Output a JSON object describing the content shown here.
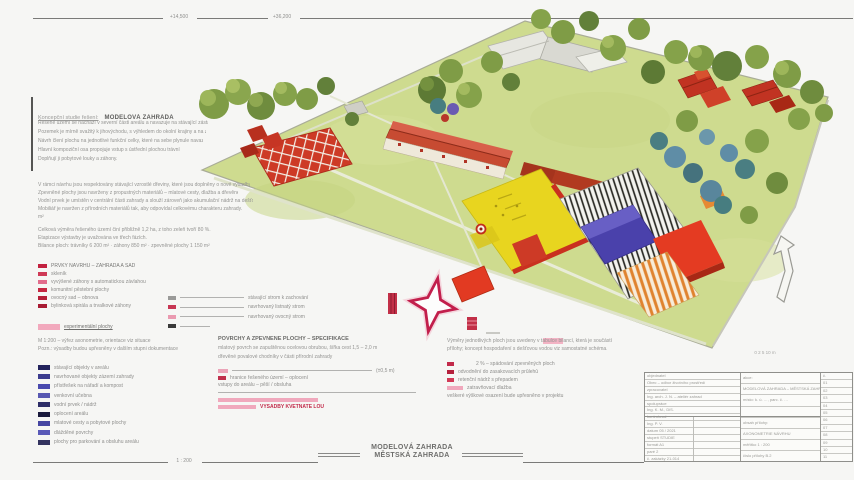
{
  "frame": {
    "top_label_1": "+14,500",
    "top_label_2": "+36,200",
    "bottom_label": "1 : 200",
    "scale_note": "0  2  5  10 m"
  },
  "caption": {
    "line1": "MODELOVÁ ZAHRADA",
    "line2": "MĚSTSKÁ ZAHRADA"
  },
  "intro": {
    "heading_light": "Koncepční studie řešení:",
    "heading_bold": "MODELOVÁ ZAHRADA",
    "para1": [
      {
        "t": "Řešené území se nachází v severní části areálu a navazuje na stávající zástavbu obce.",
        "w": 170
      },
      {
        "t": "Pozemek je mírně svažitý k jihovýchodu, s výhledem do okolní krajiny a na zahrady.",
        "w": 168
      },
      {
        "t": "Návrh člení plochu na jednotlivé funkční celky, které na sebe plynule navazují.",
        "w": 165
      },
      {
        "t": "Hlavní kompoziční osa propojuje vstup s ústřední plochou trávníku.",
        "w": 142
      },
      {
        "t": "Doplňují ji pobytové louky a záhony.",
        "w": 118
      }
    ],
    "para2": [
      {
        "t": "V rámci návrhu jsou respektovány stávající vzrostlé dřeviny, které jsou doplněny o nové výsadby ovocných stromů.",
        "w": 212
      },
      {
        "t": "Zpevněné plochy jsou navrženy z propustných materiálů – mlatové cesty, dlažba a dřevěné povaly.",
        "w": 200
      },
      {
        "t": "Vodní prvek je umístěn v centrální části zahrady a slouží zároveň jako akumulační nádrž na dešťovou vodu.",
        "w": 215
      },
      {
        "t": "Mobiliář je navržen z přírodních materiálů tak, aby odpovídal celkovému charakteru zahrady.",
        "w": 205
      },
      {
        "t": "m²",
        "w": 18
      }
    ],
    "para3": [
      {
        "t": "Celková výměra řešeného území činí přibližně 1,2 ha, z toho zeleň tvoří 80 %.",
        "w": 176
      },
      {
        "t": "Etapizace výstavby je uvažována ve třech fázích.",
        "w": 146
      },
      {
        "t": "Bilance ploch: trávníky 6 200 m² · záhony 850 m² · zpevněné plochy 1 150 m²",
        "w": 215
      }
    ]
  },
  "legend_left": {
    "red_rows": [
      {
        "sw": "#c2213f",
        "t": "PRVKY NÁVRHU – ZAHRADA A SAD",
        "tw": 106,
        "c": "#787876"
      },
      {
        "sw": "#cf3a56",
        "t": "skleník",
        "tw": 40
      },
      {
        "sw": "#e26d8c",
        "t": "vyvýšené záhony s automatickou závlahou",
        "tw": 118
      },
      {
        "sw": "#c52741",
        "t": "komunitní pěstební plochy",
        "tw": 92
      },
      {
        "sw": "#b51f38",
        "t": "ovocný sad – obnova",
        "tw": 62
      },
      {
        "sw": "#a81b33",
        "t": "bylinková spirála a trvalkové záhony",
        "tw": 98
      }
    ],
    "pink_row": {
      "sw": "#f2a9bd",
      "sww": 22,
      "swh": 6,
      "t": "experimentální plochy",
      "tw": 96,
      "c": "#6e6e6c",
      "u": true
    },
    "note_lines": [
      {
        "t": "M 1:200 – výřez axonometrie, orientace viz situace",
        "w": 128
      },
      {
        "t": "Pozn.: výsadby budou upřesněny v dalším stupni dokumentace",
        "w": 152
      }
    ],
    "blue_rows": [
      {
        "sw": "#23235c",
        "t": "stávající objekty v areálu",
        "tw": 96
      },
      {
        "sw": "#3c3c8e",
        "t": "navrhované objekty zázemí zahrady",
        "tw": 132
      },
      {
        "sw": "#4a4aae",
        "t": "přístřešek na nářadí a kompost",
        "tw": 150
      },
      {
        "sw": "#5858b2",
        "t": "venkovní učebna",
        "tw": 72
      },
      {
        "sw": "#2e2e68",
        "t": "vodní prvek / nádrž",
        "tw": 88
      },
      {
        "sw": "#1a1a3c",
        "t": "oplocení areálu",
        "tw": 70
      },
      {
        "sw": "#4646a2",
        "t": "mlatové cesty a pobytové plochy",
        "tw": 118
      },
      {
        "sw": "#5a5ab8",
        "t": "dlážděné povrchy",
        "tw": 78
      },
      {
        "sw": "#33335f",
        "t": "plochy pro parkování a obsluhu areálu",
        "tw": 142
      }
    ]
  },
  "legend_mid": {
    "rows": [
      {
        "sw": "#9a9a98",
        "rule": 64,
        "t": "stávající strom k zachování",
        "tw": 106
      },
      {
        "sw": "#c73653",
        "rule": 64,
        "t": "navrhovaný listnatý strom",
        "tw": 92
      },
      {
        "sw": "#ea9ab0",
        "rule": 64,
        "t": "navrhovaný ovocný strom",
        "tw": 100
      },
      {
        "sw": "#3a3a3a",
        "rule": 30,
        "t": "",
        "tw": 0
      }
    ]
  },
  "legend_bottom_mid": {
    "heading": "POVRCHY A ZPEVNĚNÉ PLOCHY – SPECIFIKACE",
    "lines": [
      {
        "t": "mlatový povrch se zapuštěnou ocelovou obrubou, šířka cest 1,5 – 2,0 m",
        "w": 178
      },
      {
        "t": "dřevěné povalové chodníky v části přírodní zahrady",
        "w": 172
      }
    ],
    "rows": [
      {
        "sw": "#eba4b8",
        "sww": 10,
        "rule": 140,
        "t": "(±0,5 m)",
        "tw": 36
      },
      {
        "sw": "#c0304c",
        "sww": 8,
        "t": "hranice řešeného území – oplocení",
        "tw": 190
      },
      {
        "t": "vstupy do areálu – pěší / obsluha",
        "tw": 132
      },
      {
        "rule": 198
      },
      {
        "sw": "#f0a8bc",
        "sww": 100,
        "swh": 4
      },
      {
        "sw": "#f0a8bc",
        "sww": 38,
        "swh": 4,
        "t": "VÝSADBY KVĚTNATÉ LOUKY",
        "tw": 64,
        "c": "#c22a4a",
        "b": true
      }
    ]
  },
  "legend_bottom_right": {
    "lines": [
      {
        "t": "Výměry jednotlivých ploch jsou uvedeny v tabulce bilancí, která je součástí",
        "w": 165
      },
      {
        "t": "přílohy; koncept hospodaření s dešťovou vodou viz samostatné schéma.",
        "w": 160
      }
    ],
    "rows": [
      {
        "sw": "#c22a4a",
        "sww": 7,
        "t": "2 % – spádování zpevněných ploch",
        "tw": 128,
        "pad": 18
      },
      {
        "sw": "#b5203c",
        "sww": 7,
        "t": "odvodnění do zasakovacích průlehů",
        "tw": 140
      },
      {
        "sw": "#d23a56",
        "sww": 7,
        "t": "retenční nádrž s přepadem",
        "tw": 112
      },
      {
        "sw": "#f0a8bc",
        "sww": 16,
        "t": "zatravňovací dlažba",
        "tw": 90
      },
      {
        "t": "veškeré výškové osazení bude upřesněno v projektu",
        "tw": 162
      }
    ]
  },
  "titleblock": {
    "left_rows": [
      "objednatel",
      "Obec – odbor životního prostředí",
      "zpracovatel",
      "Ing. arch. J. N. – ateliér zahrad",
      "spolupráce",
      "Ing. K. M., DiS.",
      "kontroloval",
      "Ing. P. V.",
      "datum  05 / 2021",
      "stupeň  STUDIE",
      "formát  A1",
      "paré  2",
      "č. zakázky  21-014"
    ],
    "mid_rows": [
      "akce:",
      "MODELOVÁ ZAHRADA – MĚSTSKÁ ZAHRADA",
      "místo: k. ú. …, parc. č. …",
      "",
      "obsah přílohy:",
      "AXONOMETRIE NÁVRHU",
      "měřítko  1 : 200",
      "číslo přílohy  B.2"
    ],
    "right_rows": [
      "č.",
      "01",
      "02",
      "03",
      "04",
      "05",
      "06",
      "07",
      "08",
      "09",
      "10",
      "11"
    ]
  },
  "plan": {
    "palette": {
      "lawn": "#cedb8f",
      "tree_olive": "#7f9c46",
      "tree_dark": "#5d7a35",
      "tree_teal": "#4a7e82",
      "tree_blue": "#5f8da6",
      "roof_red": "#c74b32",
      "block_red": "#e43b22",
      "yellow_field": "#e8d51f",
      "blue_court": "#4a41ab",
      "orange_stripes": "#e0832f",
      "hatch": "#2c2c26",
      "legend_crimson": "#c21f4c",
      "compass_star": "#c21f4c"
    },
    "compass": "four-point-star"
  }
}
